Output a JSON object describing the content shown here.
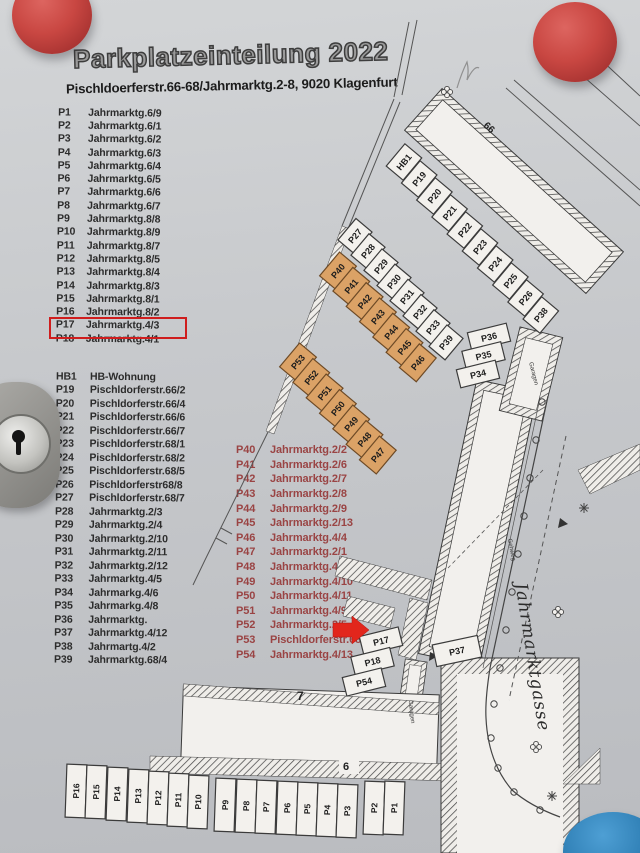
{
  "doc": {
    "title": "Parkplatzeinteilung 2022",
    "subtitle": "Pischldoerferstr.66-68/Jahrmarktg.2-8, 9020 Klagenfurt"
  },
  "lists": {
    "left_top": [
      [
        "P1",
        "Jahrmarktg.6/9"
      ],
      [
        "P2",
        "Jahrmarktg.6/1"
      ],
      [
        "P3",
        "Jahrmarktg.6/2"
      ],
      [
        "P4",
        "Jahrmarktg.6/3"
      ],
      [
        "P5",
        "Jahrmarktg.6/4"
      ],
      [
        "P6",
        "Jahrmarktg.6/5"
      ],
      [
        "P7",
        "Jahrmarktg.6/6"
      ],
      [
        "P8",
        "Jahrmarktg.6/7"
      ],
      [
        "P9",
        "Jahrmarktg.8/8"
      ],
      [
        "P10",
        "Jahrmarktg.8/9"
      ],
      [
        "P11",
        "Jahrmarktg.8/7"
      ],
      [
        "P12",
        "Jahrmarktg.8/5"
      ],
      [
        "P13",
        "Jahrmarktg.8/4"
      ],
      [
        "P14",
        "Jahrmarktg.8/3"
      ],
      [
        "P15",
        "Jahrmarktg.8/1"
      ],
      [
        "P16",
        "Jahrmarktg.8/2"
      ],
      [
        "P17",
        "Jahrmarktg.4/3"
      ],
      [
        "P18",
        "Jahrmarktg.4/1"
      ]
    ],
    "left_bottom": [
      [
        "HB1",
        "HB-Wohnung"
      ],
      [
        "P19",
        "Pischldorferstr.66/2"
      ],
      [
        "P20",
        "Pischldorferstr.66/4"
      ],
      [
        "P21",
        "Pischldorferstr.66/6"
      ],
      [
        "P22",
        "Pischldorferstr.66/7"
      ],
      [
        "P23",
        "Pischldorferstr.68/1"
      ],
      [
        "P24",
        "Pischldorferstr.68/2"
      ],
      [
        "P25",
        "Pischldorferstr.68/5"
      ],
      [
        "P26",
        "Pischldorferstr68/8"
      ],
      [
        "P27",
        "Pischldorferstr.68/7"
      ],
      [
        "P28",
        "Jahrmarktg.2/3"
      ],
      [
        "P29",
        "Jahrmarktg.2/4"
      ],
      [
        "P30",
        "Jahrmarktg.2/10"
      ],
      [
        "P31",
        "Jahrmarktg.2/11"
      ],
      [
        "P32",
        "Jahrmarktg.2/12"
      ],
      [
        "P33",
        "Jahrmarktg.4/5"
      ],
      [
        "P34",
        "Jahrmarkg.4/6"
      ],
      [
        "P35",
        "Jahrmarkg.4/8"
      ],
      [
        "P36",
        "Jahrmarktg."
      ],
      [
        "P37",
        "Jahrmarktg.4/12"
      ],
      [
        "P38",
        "Jahrmartg.4/2"
      ],
      [
        "P39",
        "Jahrmarktg.68/4"
      ]
    ],
    "middle_red": [
      [
        "P40",
        "Jahrmarktg.2/2"
      ],
      [
        "P41",
        "Jahrmarktg.2/6"
      ],
      [
        "P42",
        "Jahrmarktg.2/7"
      ],
      [
        "P43",
        "Jahrmarktg.2/8"
      ],
      [
        "P44",
        "Jahrmarktg.2/9"
      ],
      [
        "P45",
        "Jahrmarktg.2/13"
      ],
      [
        "P46",
        "Jahrmarktg.4/4"
      ],
      [
        "P47",
        "Jahrmarktg.2/1"
      ],
      [
        "P48",
        "Jahrmarktg.4/7"
      ],
      [
        "P49",
        "Jahrmarktg.4/10"
      ],
      [
        "P50",
        "Jahrmarktg.4/11"
      ],
      [
        "P51",
        "Jahrmarktg.4/9"
      ],
      [
        "P52",
        "Jahrmarktg.2/5"
      ],
      [
        "P53",
        "Pischldorferstr.68/9"
      ],
      [
        "P54",
        "Jahrmarktg.4/13"
      ]
    ]
  },
  "map": {
    "row_hb": [
      "HB1",
      "P19",
      "P20",
      "P21",
      "P22",
      "P23",
      "P24",
      "P25",
      "P26",
      "P38"
    ],
    "row_p27": [
      "P27",
      "P28",
      "P29",
      "P30",
      "P31",
      "P32",
      "P33",
      "P39"
    ],
    "row_p40": [
      "P40",
      "P41",
      "P42",
      "P43",
      "P44",
      "P45",
      "P46"
    ],
    "row_p53": [
      "P53",
      "P52",
      "P51",
      "P50",
      "P49",
      "P48",
      "P47"
    ],
    "stack_p36": [
      "P36",
      "P35",
      "P34"
    ],
    "stack_p17": [
      "P17",
      "P18",
      "P54"
    ],
    "p37": [
      "P37"
    ],
    "bottom_row": [
      "P16",
      "P15",
      "P14",
      "P13",
      "P12",
      "P11",
      "P10",
      "P9",
      "P8",
      "P7",
      "P6",
      "P5",
      "P4",
      "P3",
      "P2",
      "P1"
    ],
    "labels": {
      "b66": "66",
      "b7": "7",
      "b6": "6"
    },
    "street": "Jahrmarktgasse",
    "gehweg": "Gehweg",
    "garage_large": "Garagen",
    "garage_small": "Garagen"
  },
  "annotations": {
    "list_highlight_target": "P17",
    "map_arrow_target": "P17"
  },
  "colors": {
    "highlight_red": "#cf1d1d",
    "arrow_red": "#e2261c",
    "space_orange": "#dba266",
    "list_red": "#9a4444"
  }
}
